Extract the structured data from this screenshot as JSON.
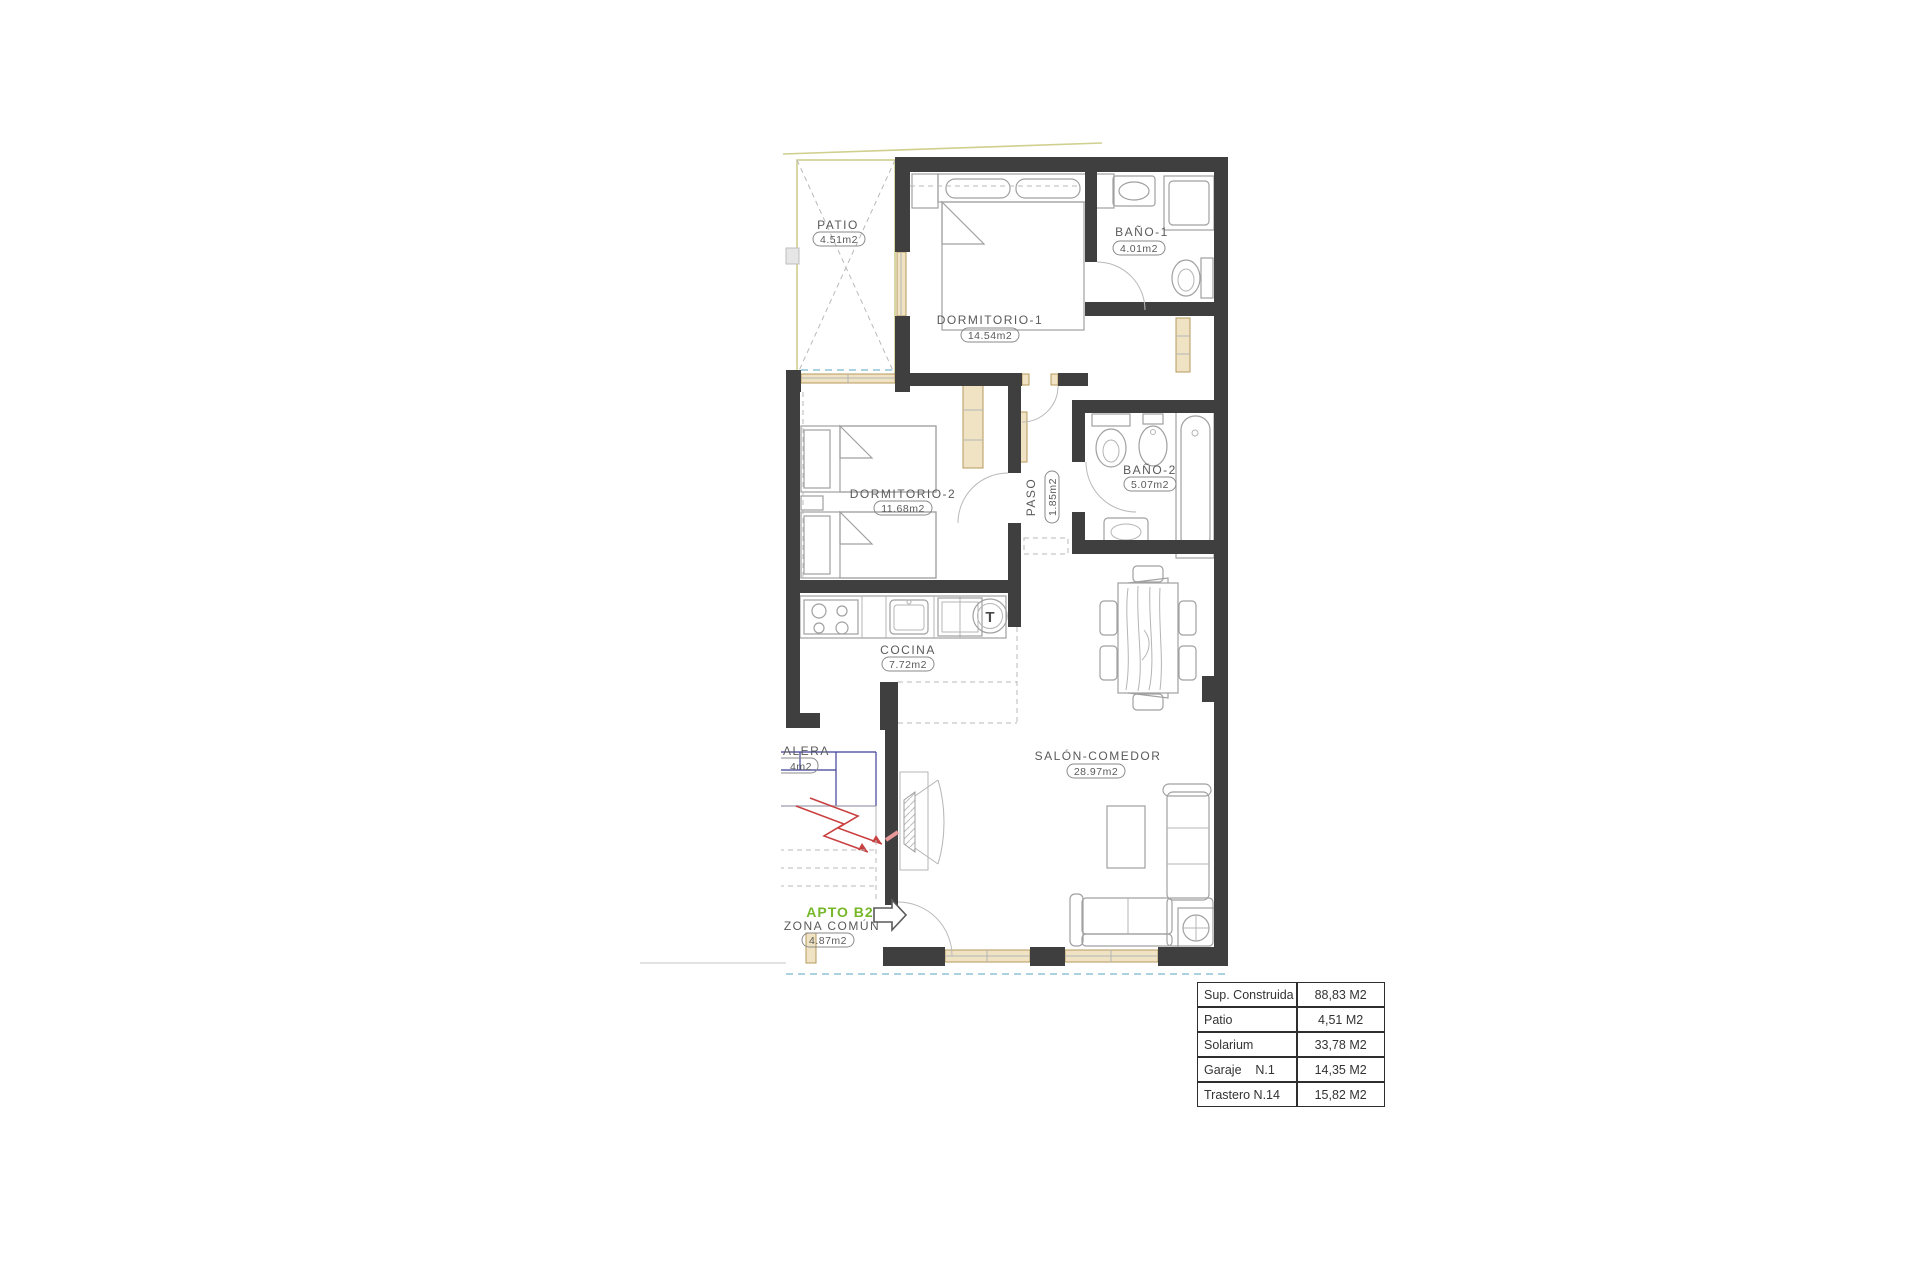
{
  "plan": {
    "apartment_tag": "APTO B2",
    "rooms": [
      {
        "name": "PATIO",
        "area": "4.51m2"
      },
      {
        "name": "DORMITORIO-1",
        "area": "14.54m2"
      },
      {
        "name": "BAÑO-1",
        "area": "4.01m2"
      },
      {
        "name": "DORMITORIO-2",
        "area": "11.68m2"
      },
      {
        "name": "PASO",
        "area": "1.85m2"
      },
      {
        "name": "BAÑO-2",
        "area": "5.07m2"
      },
      {
        "name": "COCINA",
        "area": "7.72m2"
      },
      {
        "name": "SALÓN-COMEDOR",
        "area": "28.97m2"
      },
      {
        "name": "ALERA",
        "area": "4m2"
      },
      {
        "name": "ZONA COMÚN",
        "area": "4.87m2"
      }
    ],
    "kitchen": {
      "termo_label": "T"
    },
    "colors": {
      "wall": "#3f3f3f",
      "carpentry_tan": "#b7995e",
      "boundary_khaki": "#cfcf8e",
      "stairs_navy": "#3f3f96",
      "stairs_arrow_red": "#c94040",
      "apto_green": "#76b82a",
      "water_dash_blue": "#8fc3d4"
    }
  },
  "summary_table": {
    "rows": [
      {
        "label": "Sup. Construida",
        "value": "88,83 M2"
      },
      {
        "label": "Patio",
        "value": "4,51 M2"
      },
      {
        "label": "Solarium",
        "value": "33,78 M2"
      },
      {
        "label": "Garaje    N.1",
        "value": "14,35 M2"
      },
      {
        "label": "Trastero N.14",
        "value": "15,82 M2"
      }
    ]
  }
}
